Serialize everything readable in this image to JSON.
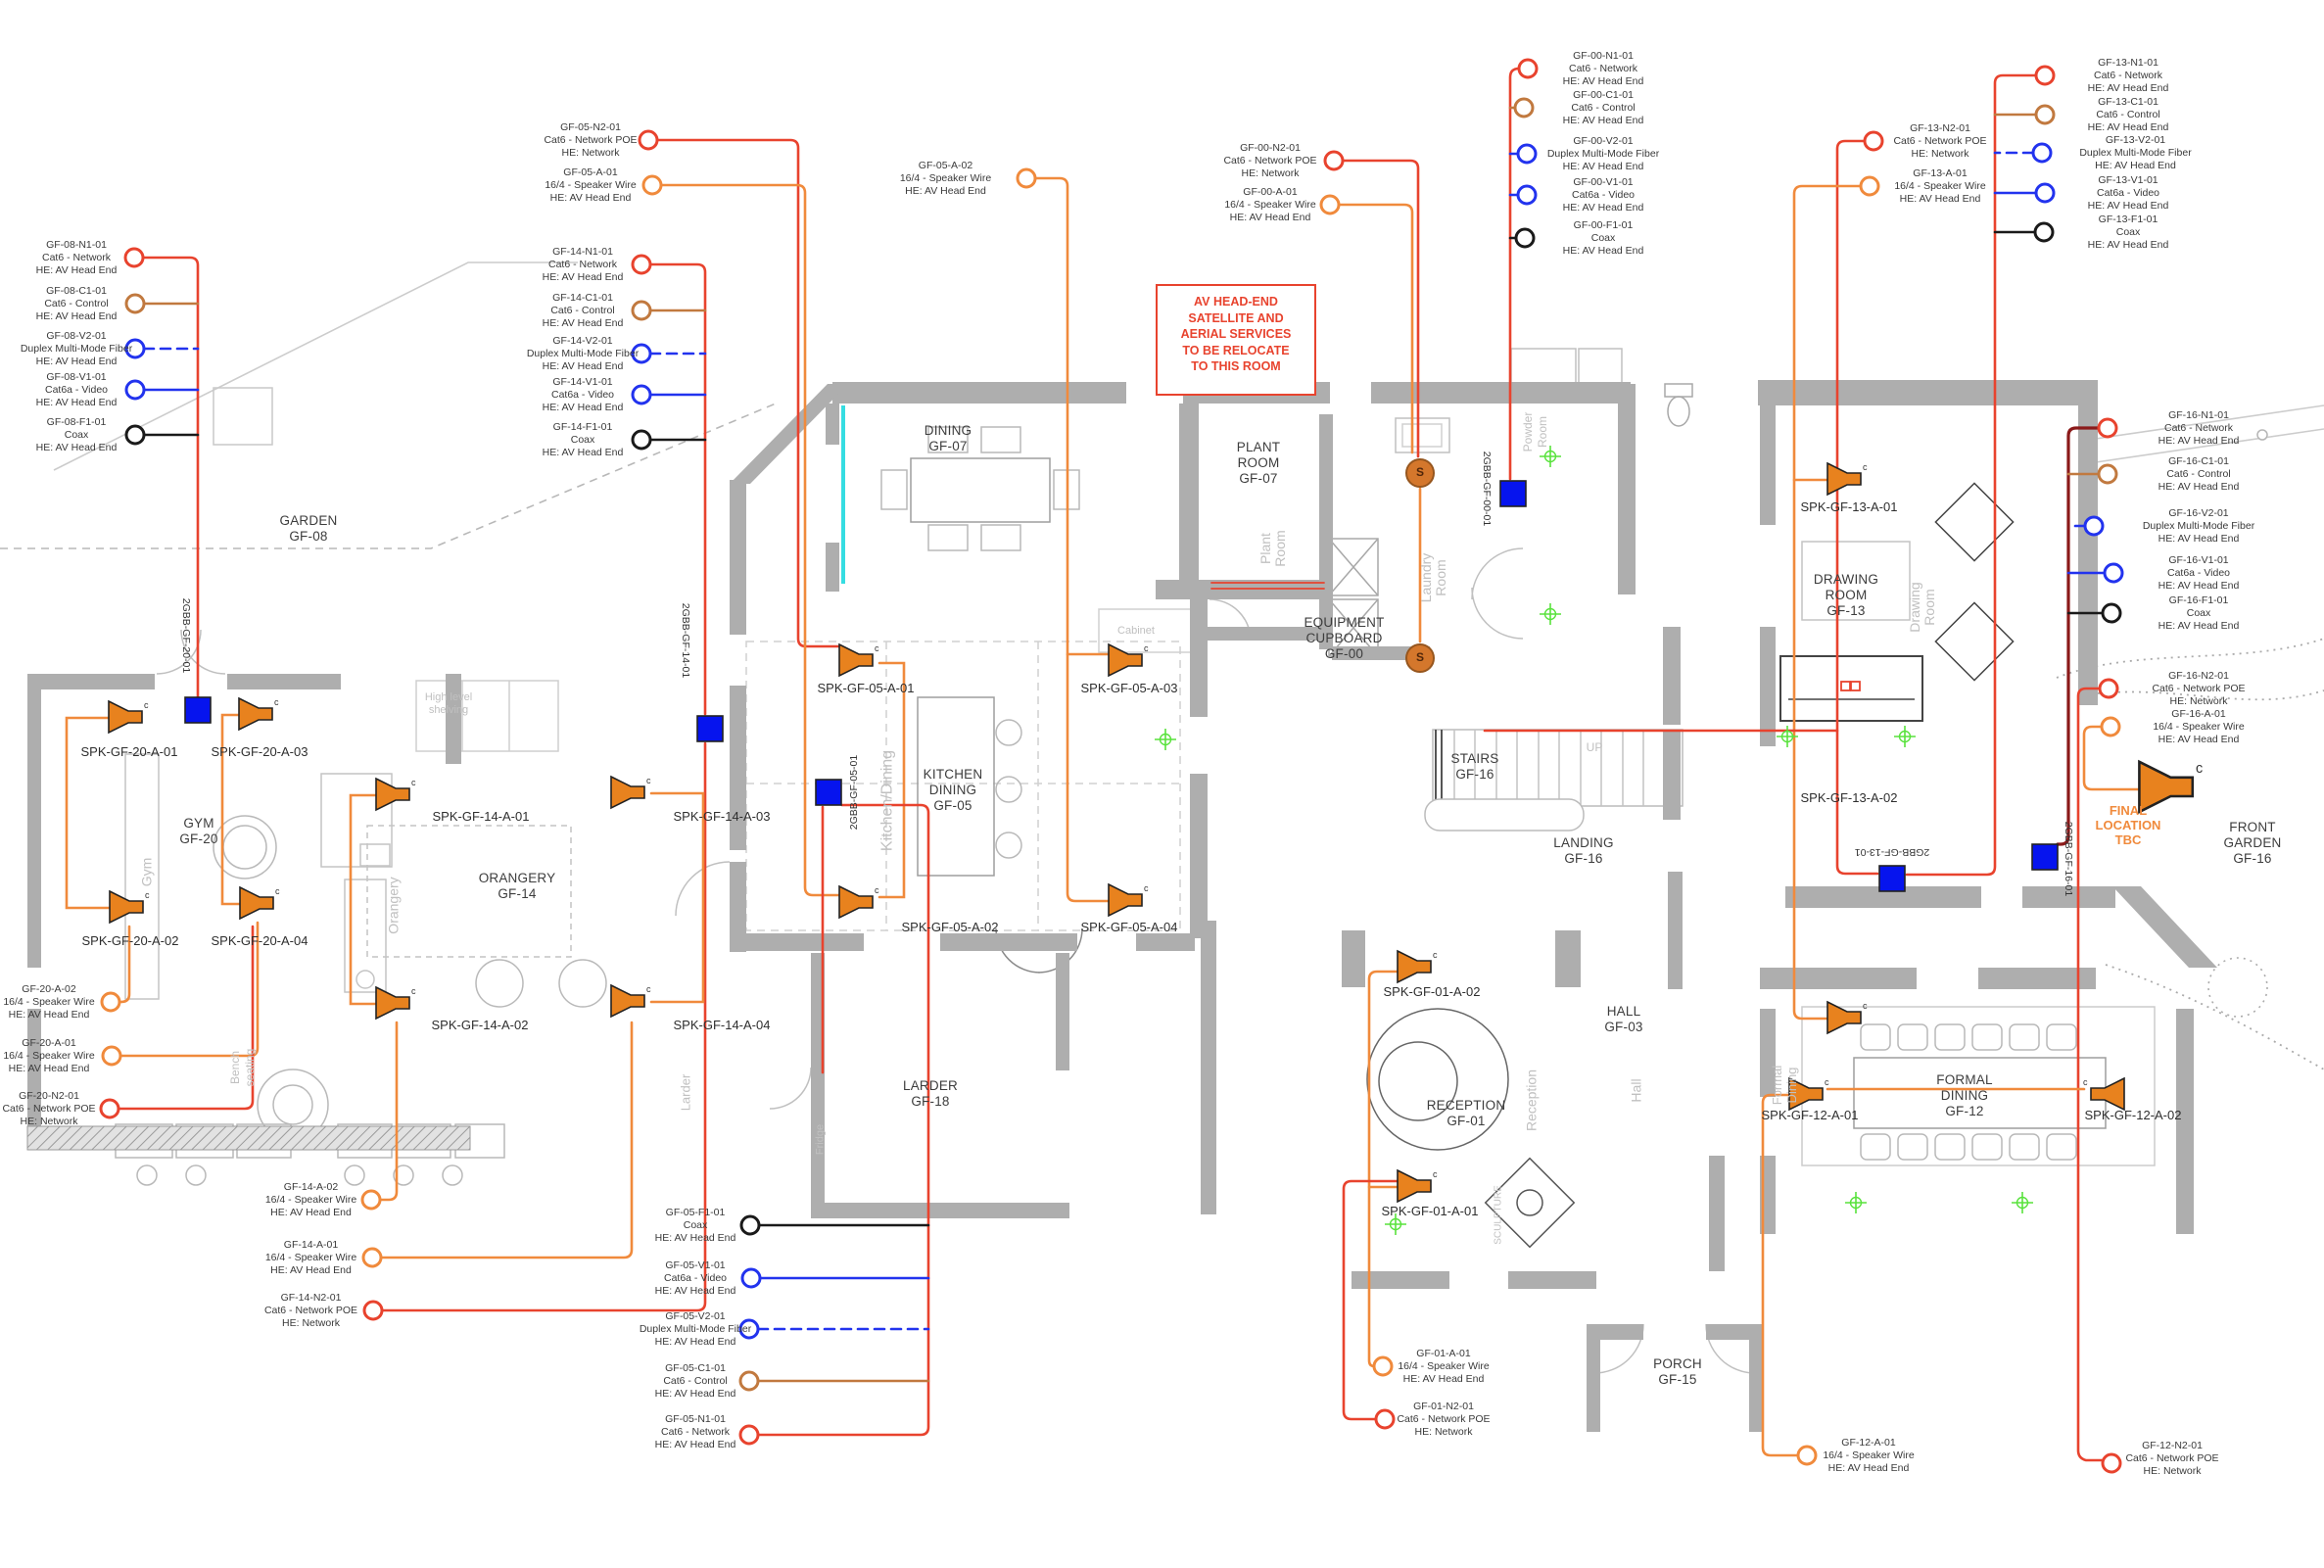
{
  "note_box": {
    "lines": [
      "AV HEAD-END",
      "SATELLITE AND",
      "AERIAL SERVICES",
      "TO BE RELOCATE",
      "TO THIS ROOM"
    ]
  },
  "final_location": {
    "lines": [
      "FINAL",
      "LOCATION",
      "TBC"
    ]
  },
  "satellite_label": "S",
  "rooms": {
    "garden": {
      "name": "GARDEN",
      "code": "GF-08"
    },
    "dining": {
      "name": "DINING",
      "code": "GF-07"
    },
    "plant_room": {
      "name": "PLANT ROOM",
      "code": "GF-07"
    },
    "equipment_cupboard": {
      "name": "EQUIPMENT CUPBOARD",
      "code": "GF-00"
    },
    "kitchen_dining": {
      "name": "KITCHEN DINING",
      "code": "GF-05"
    },
    "gym": {
      "name": "GYM",
      "code": "GF-20"
    },
    "orangery": {
      "name": "ORANGERY",
      "code": "GF-14"
    },
    "drawing_room": {
      "name": "DRAWING ROOM",
      "code": "GF-13"
    },
    "stairs": {
      "name": "STAIRS",
      "code": "GF-16"
    },
    "landing": {
      "name": "LANDING",
      "code": "GF-16"
    },
    "hall": {
      "name": "HALL",
      "code": "GF-03"
    },
    "reception": {
      "name": "RECEPTION",
      "code": "GF-01"
    },
    "larder": {
      "name": "LARDER",
      "code": "GF-18"
    },
    "formal_dining": {
      "name": "FORMAL DINING",
      "code": "GF-12"
    },
    "porch": {
      "name": "PORCH",
      "code": "GF-15"
    },
    "front_garden": {
      "name": "FRONT GARDEN",
      "code": "GF-16"
    }
  },
  "underlay": {
    "plant": "Plant Room",
    "laundry": "Laundry Room",
    "powder": "Powder Room",
    "kitchen": "Kitchen/Dining",
    "gym": "Gym",
    "orangery": "Orangery",
    "drawing": "Drawing Room",
    "reception": "Reception",
    "hall": "Hall",
    "formal": "Formal Dining",
    "larder": "Larder",
    "fridge": "Fridge",
    "bench": "Bench seating",
    "shelving": "High level shelving",
    "cabinet": "Cabinet",
    "sculpture": "SCULPTURE",
    "up": "UP"
  },
  "panels": {
    "gf20": "2GBB-GF-20-01",
    "gf14": "2GBB-GF-14-01",
    "gf05": "2GBB-GF-05-01",
    "gf00": "2GBB-GF-00-01",
    "gf13": "2GBB-GF-13-01",
    "gf16": "2GBB-GF-16-01"
  },
  "speakers": {
    "spk20a1": "SPK-GF-20-A-01",
    "spk20a2": "SPK-GF-20-A-02",
    "spk20a3": "SPK-GF-20-A-03",
    "spk20a4": "SPK-GF-20-A-04",
    "spk14a1": "SPK-GF-14-A-01",
    "spk14a2": "SPK-GF-14-A-02",
    "spk14a3": "SPK-GF-14-A-03",
    "spk14a4": "SPK-GF-14-A-04",
    "spk05a1": "SPK-GF-05-A-01",
    "spk05a2": "SPK-GF-05-A-02",
    "spk05a3": "SPK-GF-05-A-03",
    "spk05a4": "SPK-GF-05-A-04",
    "spk13a1": "SPK-GF-13-A-01",
    "spk13a2": "SPK-GF-13-A-02",
    "spk01a1": "SPK-GF-01-A-01",
    "spk01a2": "SPK-GF-01-A-02",
    "spk12a1": "SPK-GF-12-A-01",
    "spk12a2": "SPK-GF-12-A-02"
  },
  "drops": {
    "g08n1": {
      "id": "GF-08-N1-01",
      "type": "Cat6 - Network",
      "he": "HE: AV Head End"
    },
    "g08c1": {
      "id": "GF-08-C1-01",
      "type": "Cat6 - Control",
      "he": "HE: AV Head End"
    },
    "g08v2": {
      "id": "GF-08-V2-01",
      "type": "Duplex Multi-Mode Fiber",
      "he": "HE: AV Head End"
    },
    "g08v1": {
      "id": "GF-08-V1-01",
      "type": "Cat6a - Video",
      "he": "HE: AV Head End"
    },
    "g08f1": {
      "id": "GF-08-F1-01",
      "type": "Coax",
      "he": "HE: AV Head End"
    },
    "g05n2": {
      "id": "GF-05-N2-01",
      "type": "Cat6 - Network POE",
      "he": "HE: Network"
    },
    "g05a1": {
      "id": "GF-05-A-01",
      "type": "16/4 - Speaker Wire",
      "he": "HE: AV Head End"
    },
    "g05a2": {
      "id": "GF-05-A-02",
      "type": "16/4 - Speaker Wire",
      "he": "HE: AV Head End"
    },
    "g14n1": {
      "id": "GF-14-N1-01",
      "type": "Cat6 - Network",
      "he": "HE: AV Head End"
    },
    "g14c1": {
      "id": "GF-14-C1-01",
      "type": "Cat6 - Control",
      "he": "HE: AV Head End"
    },
    "g14v2": {
      "id": "GF-14-V2-01",
      "type": "Duplex Multi-Mode Fiber",
      "he": "HE: AV Head End"
    },
    "g14v1": {
      "id": "GF-14-V1-01",
      "type": "Cat6a - Video",
      "he": "HE: AV Head End"
    },
    "g14f1": {
      "id": "GF-14-F1-01",
      "type": "Coax",
      "he": "HE: AV Head End"
    },
    "g00n2": {
      "id": "GF-00-N2-01",
      "type": "Cat6 - Network POE",
      "he": "HE: Network"
    },
    "g00a1": {
      "id": "GF-00-A-01",
      "type": "16/4 - Speaker Wire",
      "he": "HE: AV Head End"
    },
    "g00n1": {
      "id": "GF-00-N1-01",
      "type": "Cat6 - Network",
      "he": "HE: AV Head End"
    },
    "g00c1": {
      "id": "GF-00-C1-01",
      "type": "Cat6 - Control",
      "he": "HE: AV Head End"
    },
    "g00v2": {
      "id": "GF-00-V2-01",
      "type": "Duplex Multi-Mode Fiber",
      "he": "HE: AV Head End"
    },
    "g00v1": {
      "id": "GF-00-V1-01",
      "type": "Cat6a - Video",
      "he": "HE: AV Head End"
    },
    "g00f1": {
      "id": "GF-00-F1-01",
      "type": "Coax",
      "he": "HE: AV Head End"
    },
    "g13n2": {
      "id": "GF-13-N2-01",
      "type": "Cat6 - Network POE",
      "he": "HE: Network"
    },
    "g13a1": {
      "id": "GF-13-A-01",
      "type": "16/4 - Speaker Wire",
      "he": "HE: AV Head End"
    },
    "g13n1": {
      "id": "GF-13-N1-01",
      "type": "Cat6 - Network",
      "he": "HE: AV Head End"
    },
    "g13c1": {
      "id": "GF-13-C1-01",
      "type": "Cat6 - Control",
      "he": "HE: AV Head End"
    },
    "g13v2": {
      "id": "GF-13-V2-01",
      "type": "Duplex Multi-Mode Fiber",
      "he": "HE: AV Head End"
    },
    "g13v1": {
      "id": "GF-13-V1-01",
      "type": "Cat6a - Video",
      "he": "HE: AV Head End"
    },
    "g13f1": {
      "id": "GF-13-F1-01",
      "type": "Coax",
      "he": "HE: AV Head End"
    },
    "g16n1": {
      "id": "GF-16-N1-01",
      "type": "Cat6 - Network",
      "he": "HE: AV Head End"
    },
    "g16c1": {
      "id": "GF-16-C1-01",
      "type": "Cat6 - Control",
      "he": "HE: AV Head End"
    },
    "g16v2": {
      "id": "GF-16-V2-01",
      "type": "Duplex Multi-Mode Fiber",
      "he": "HE: AV Head End"
    },
    "g16v1": {
      "id": "GF-16-V1-01",
      "type": "Cat6a - Video",
      "he": "HE: AV Head End"
    },
    "g16f1": {
      "id": "GF-16-F1-01",
      "type": "Coax",
      "he": "HE: AV Head End"
    },
    "g16n2": {
      "id": "GF-16-N2-01",
      "type": "Cat6 - Network POE",
      "he": "HE: Network"
    },
    "g16a1": {
      "id": "GF-16-A-01",
      "type": "16/4 - Speaker Wire",
      "he": "HE: AV Head End"
    },
    "g20a2": {
      "id": "GF-20-A-02",
      "type": "16/4 - Speaker Wire",
      "he": "HE: AV Head End"
    },
    "g20a1": {
      "id": "GF-20-A-01",
      "type": "16/4 - Speaker Wire",
      "he": "HE: AV Head End"
    },
    "g20n2": {
      "id": "GF-20-N2-01",
      "type": "Cat6 - Network POE",
      "he": "HE: Network"
    },
    "g14ba2": {
      "id": "GF-14-A-02",
      "type": "16/4 - Speaker Wire",
      "he": "HE: AV Head End"
    },
    "g14ba1": {
      "id": "GF-14-A-01",
      "type": "16/4 - Speaker Wire",
      "he": "HE: AV Head End"
    },
    "g14bn2": {
      "id": "GF-14-N2-01",
      "type": "Cat6 - Network POE",
      "he": "HE: Network"
    },
    "g05f1": {
      "id": "GF-05-F1-01",
      "type": "Coax",
      "he": "HE: AV Head End"
    },
    "g05v1": {
      "id": "GF-05-V1-01",
      "type": "Cat6a - Video",
      "he": "HE: AV Head End"
    },
    "g05v2": {
      "id": "GF-05-V2-01",
      "type": "Duplex Multi-Mode Fiber",
      "he": "HE: AV Head End"
    },
    "g05c1": {
      "id": "GF-05-C1-01",
      "type": "Cat6 - Control",
      "he": "HE: AV Head End"
    },
    "g05n1": {
      "id": "GF-05-N1-01",
      "type": "Cat6 - Network",
      "he": "HE: AV Head End"
    },
    "g01a1": {
      "id": "GF-01-A-01",
      "type": "16/4 - Speaker Wire",
      "he": "HE: AV Head End"
    },
    "g01n2": {
      "id": "GF-01-N2-01",
      "type": "Cat6 - Network POE",
      "he": "HE: Network"
    },
    "g12a1": {
      "id": "GF-12-A-01",
      "type": "16/4 - Speaker Wire",
      "he": "HE: AV Head End"
    },
    "g12n2": {
      "id": "GF-12-N2-01",
      "type": "Cat6 - Network POE",
      "he": "HE: Network"
    }
  },
  "colors": {
    "network": "#e8432e",
    "control": "#c1793f",
    "fiber": "#2233ee",
    "video": "#2233ee",
    "coax": "#1a1a1a",
    "speaker_wire": "#f08a3c",
    "trunk_dark": "#8b1a1a",
    "panel_blue": "#0614ee",
    "satellite": "#d4772c",
    "note_red": "#e8432e",
    "wall_gray": "#aeaeae",
    "glazing_cyan": "#35dde2",
    "marker_green": "#58e23c"
  }
}
